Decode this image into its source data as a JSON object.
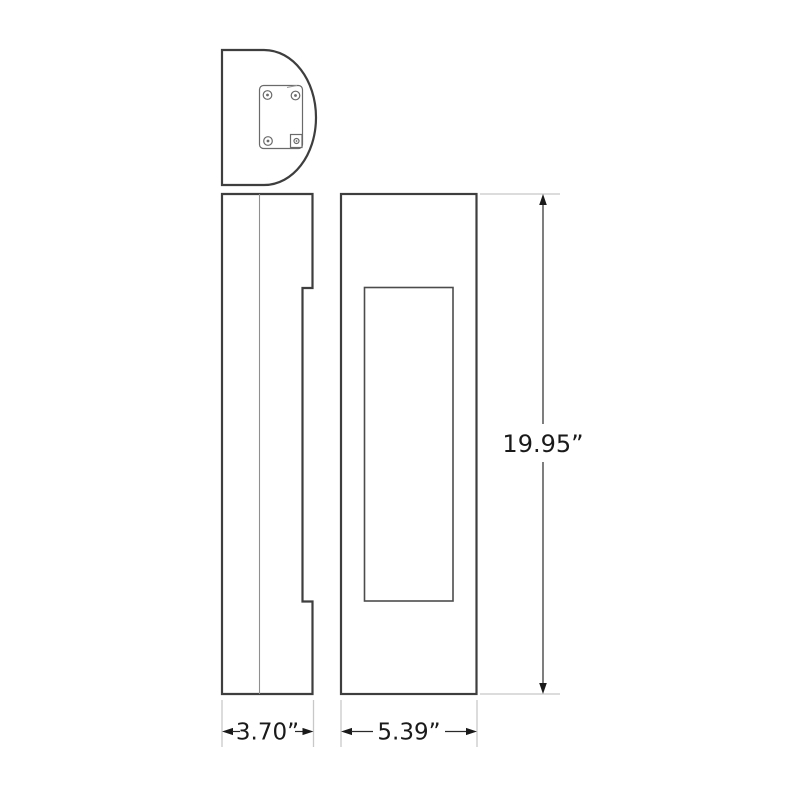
{
  "page": {
    "background": "#ffffff"
  },
  "drawing": {
    "type": "product-dimension-drawing",
    "dimensions": {
      "height": {
        "label": "19.95”"
      },
      "depth": {
        "label": "3.70”"
      },
      "width": {
        "label": "5.39”"
      }
    },
    "colors": {
      "outline": "#3e3e3e",
      "detail_line": "#6a6a6a",
      "inner_line": "#8f8f8f",
      "inner_rect_line": "#4c4c4c",
      "extension_line": "#c8c8c8",
      "dimension_line": "#2a2a2a",
      "text": "#1a1a1a",
      "background": "#ffffff"
    }
  }
}
